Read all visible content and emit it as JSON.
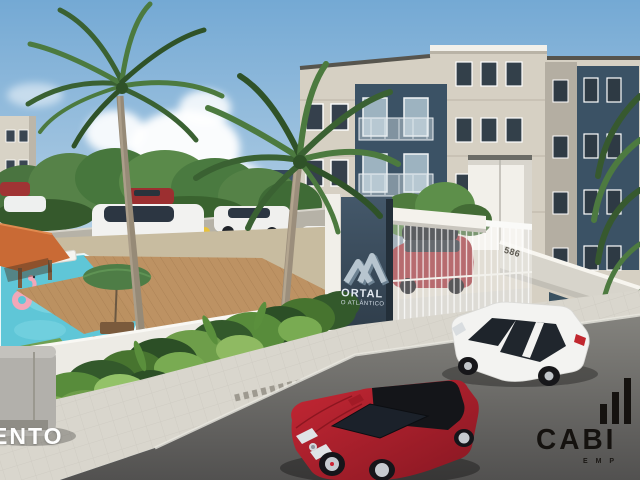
{
  "entrance": {
    "sign": {
      "logo_icon": "m-wave-icon",
      "line1": "ORTAL",
      "line2": "O ATLÂNTICO"
    },
    "gate_number": "586"
  },
  "watermarks": {
    "left_text": "ENTO",
    "brand": {
      "icon": "bars-icon",
      "text": "CABI",
      "subtext": "E M P"
    }
  },
  "palette": {
    "sky_top": "#74a9d4",
    "sky_horizon": "#cfe0ec",
    "building_beige": "#d6d0c3",
    "building_accent": "#3b5265",
    "gray_strip": "#b4aea2",
    "pool_water": "#5fc6d7",
    "deck_wood": "#bb9161",
    "umbrella_green": "#4e7d46",
    "foliage_dark": "#2c4f26",
    "foliage_light": "#6e9e4a",
    "wall_white": "#edebe5",
    "sidewalk": "#d9d6cd",
    "street_gray": "#6e6d69",
    "car_red": "#b01f2e",
    "car_white": "#f3f3f1",
    "suv_red": "#992b32",
    "flamingo_pink": "#f2a7b8",
    "pillar_blue": "#36495a"
  }
}
